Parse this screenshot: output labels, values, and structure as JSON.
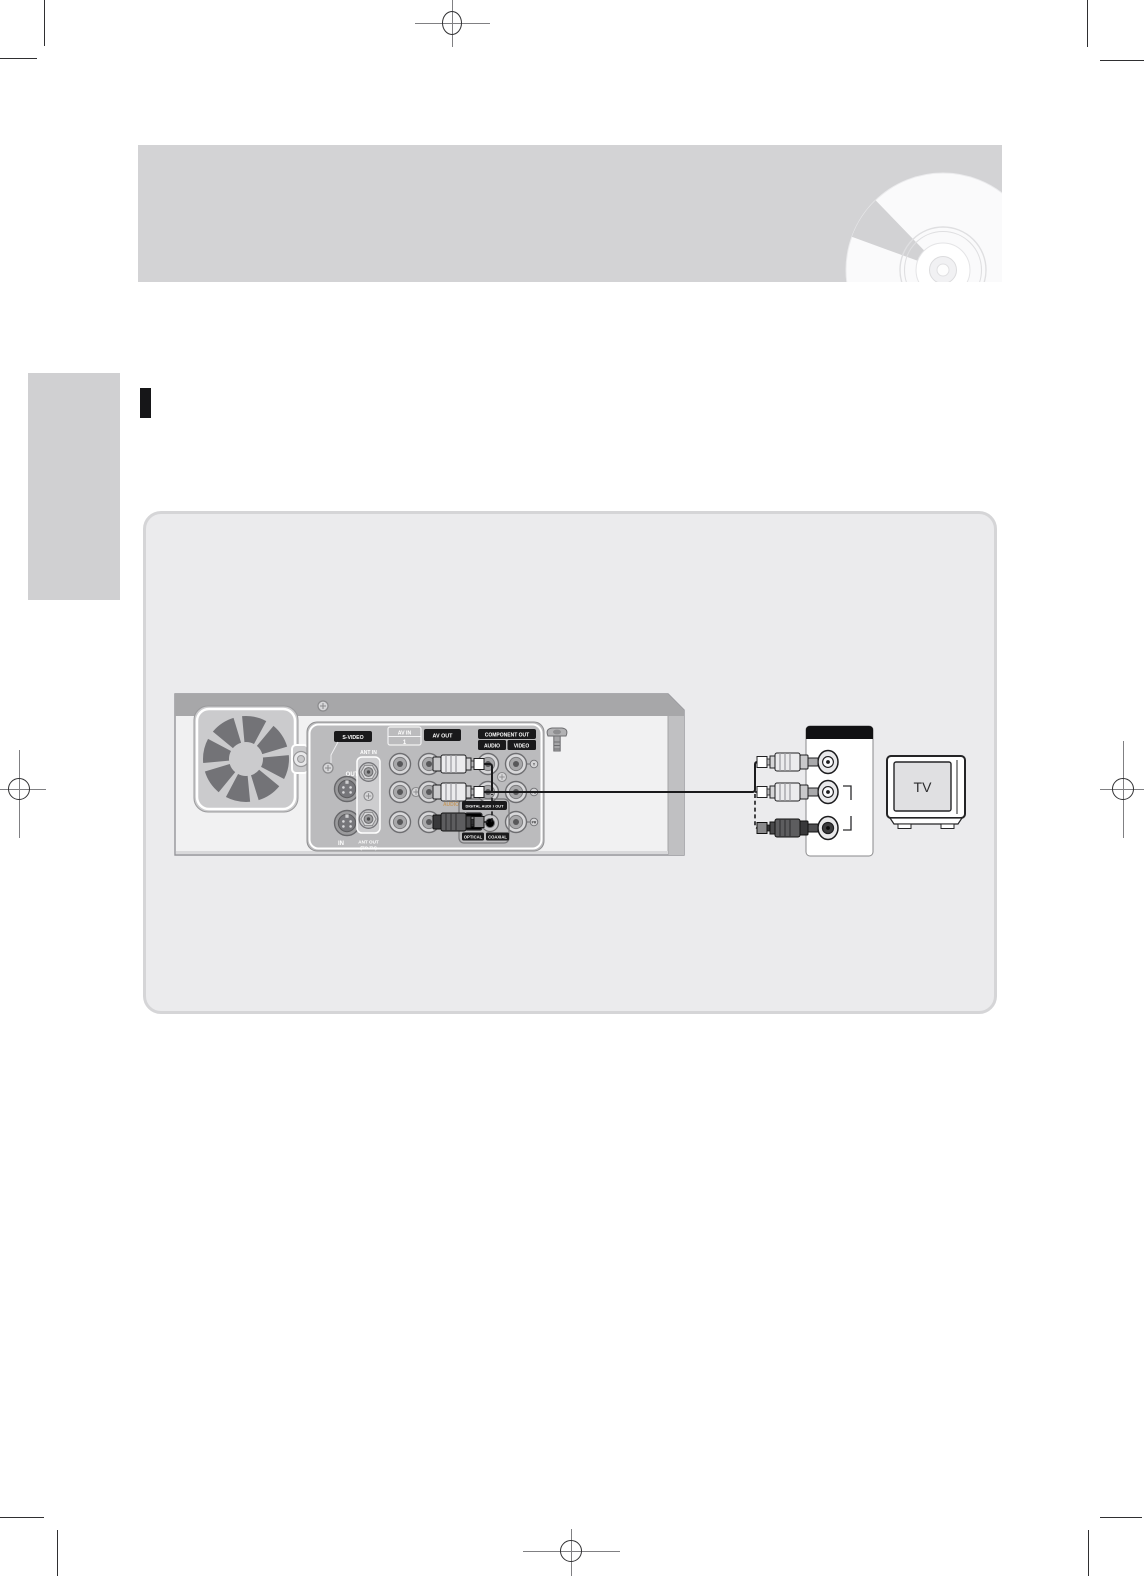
{
  "palette": {
    "header_band": "#d3d3d5",
    "sidebar_tab": "#d0d0d2",
    "panel_bg": "#ebebed",
    "panel_border": "#d5d5d7",
    "section_marker": "#161618",
    "cable": "#1a1a1c",
    "audio_accent_text": "#c49a62"
  },
  "diagram": {
    "recorder": {
      "labels": {
        "s_video": "S-VIDEO",
        "out": "OUT",
        "in": "IN",
        "ant_in": "ANT IN",
        "ant_out": "ANT OUT",
        "ant_out_sub": "(TO TV)",
        "av_in": "AV IN",
        "av_in_number": "1",
        "av_out": "AV OUT",
        "component_out": "COMPONENT OUT",
        "component_audio": "AUDIO",
        "component_video": "VIDEO",
        "audio": "AUDIO",
        "digital_audio_out": "DIGITAL AUDIO OUT",
        "optical": "OPTICAL",
        "coaxial": "COAXIAL",
        "video_jack_markers": [
          "Y",
          "PB",
          "PR"
        ]
      }
    },
    "tv": {
      "screen_label": "TV"
    }
  }
}
